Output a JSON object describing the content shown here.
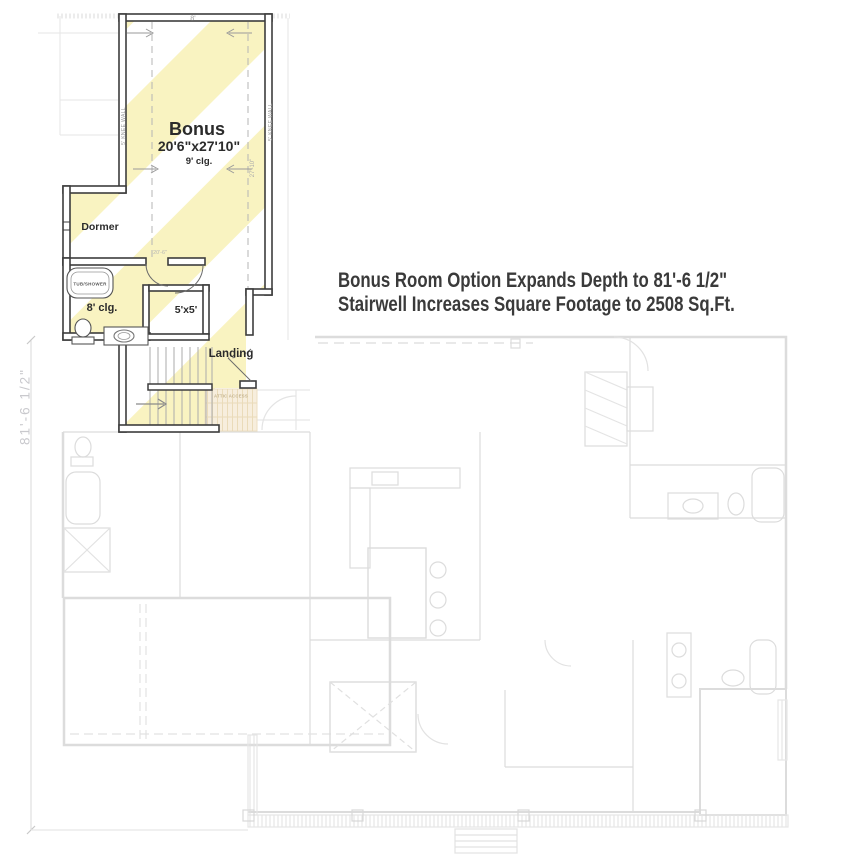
{
  "plan": {
    "bonus_label": "Bonus",
    "bonus_dimensions": "20'6\"x27'10\"",
    "bonus_ceiling": "9' clg.",
    "dormer_label": "Dormer",
    "bath_ceiling": "8' clg.",
    "tub_label": "TUB/SHOWER",
    "closet_label": "5'x5'",
    "landing_label": "Landing",
    "attic_label": "ATTIC ACCESS",
    "knee_wall_left": "5' KNEE WALL",
    "knee_wall_right": "5' KNEE WALL",
    "dim_top": "8'",
    "dim_width": "20'-6\"",
    "dim_height": "27'-10\"",
    "dim_overall_depth": "81'-6 1/2\""
  },
  "annotation": {
    "line1": "Bonus Room Option Expands Depth to 81'-6 1/2\"",
    "line2": "Stairwell Increases Square Footage to 2508 Sq.Ft."
  },
  "colors": {
    "stripe_yellow": "#f9f3c1",
    "wall_dark": "#3d3d3d",
    "ghost_gray": "#dcdcdc",
    "attic_tan": "#f7eedd",
    "annotation_text": "#3a3a3a",
    "dim_gray": "#9f9f9f",
    "overall_dim_gray": "#c9c9cd"
  }
}
